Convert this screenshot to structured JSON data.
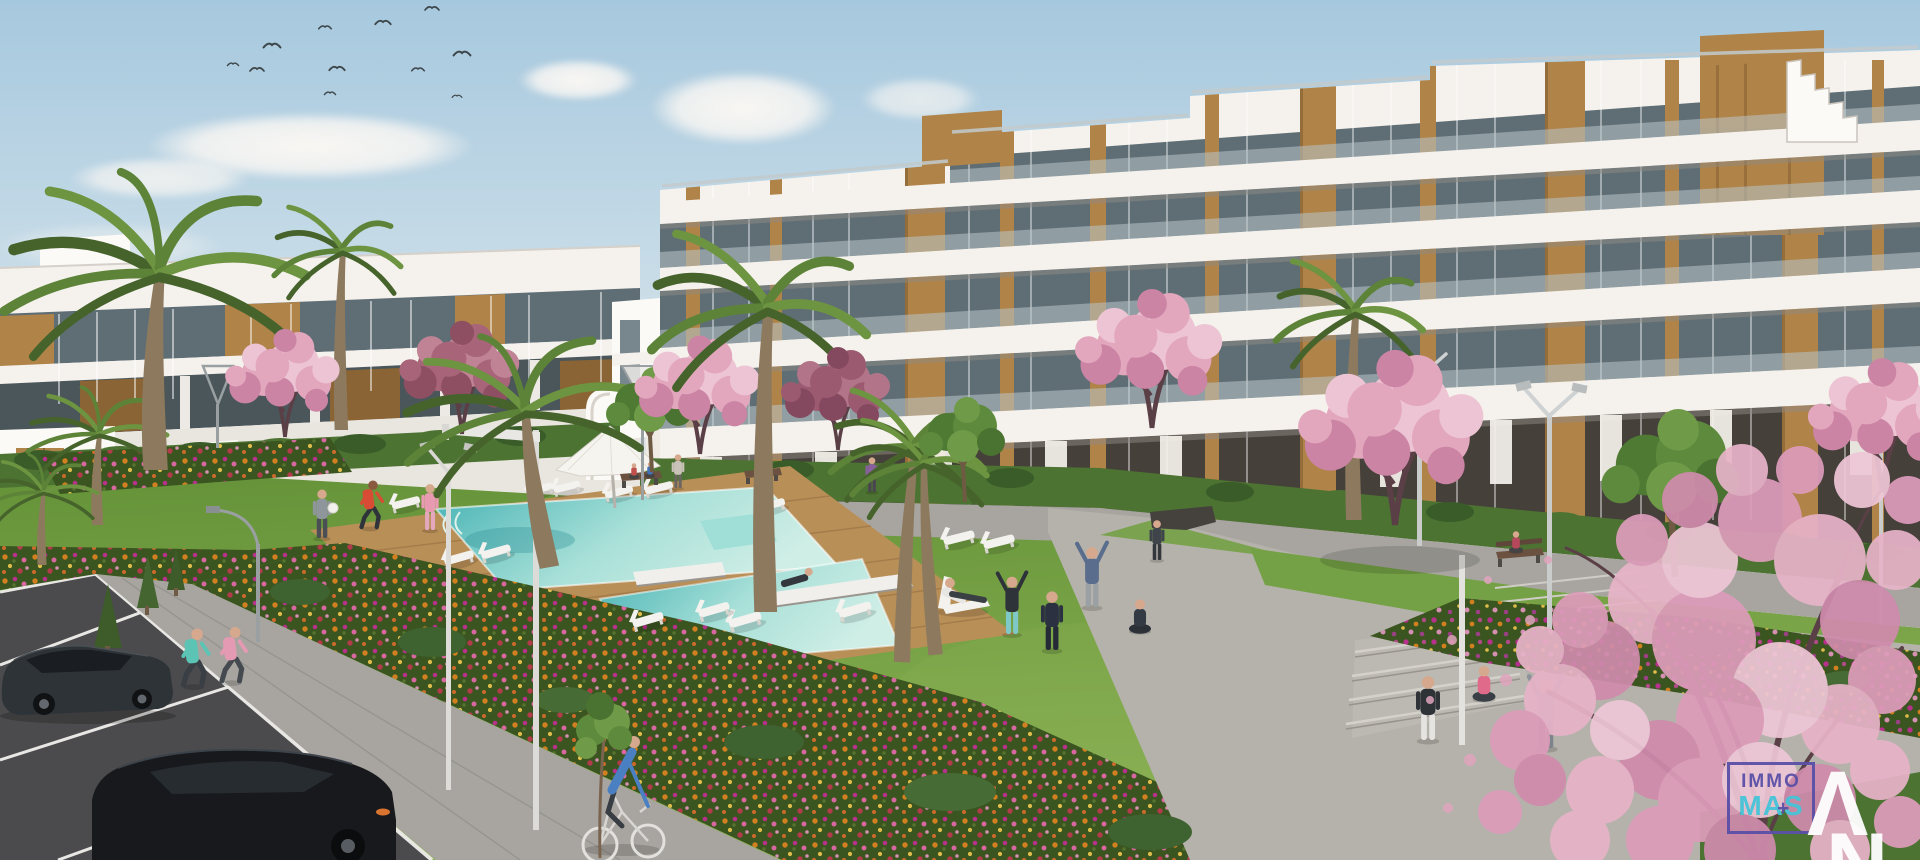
{
  "watermark": {
    "line1": "IMMO",
    "line2": "MAS",
    "plus": "+",
    "letter_top": "Λ",
    "letter_bottom": "N"
  },
  "scene": {
    "description": "3D architectural rendering of a modern white apartment complex with wooden accent panels, a communal swimming pool with timber deck, sun loungers and a parasol, lawns with residents exercising and doing yoga, colourful flower beds, palm and cherry-blossom trees, footpaths, benches, street lamps, a cyclist, two joggers and a parking area with two dark cars under a blue sky with birds",
    "people_count": 22,
    "cars_count": 2,
    "elements": [
      "sky",
      "clouds",
      "birds",
      "left-apartment-building",
      "right-apartment-building",
      "arched-stairwell",
      "swimming-pool",
      "pool-deck",
      "sun-loungers",
      "parasol",
      "lawn",
      "flower-beds",
      "palm-trees",
      "blossom-trees",
      "green-trees",
      "hedges",
      "footpaths",
      "plaza",
      "steps",
      "benches",
      "street-lamps",
      "people-exercising",
      "joggers",
      "cyclist",
      "parking-lot",
      "cars",
      "developer-watermark"
    ]
  },
  "palette": {
    "sky_top": "#a6c8de",
    "sky_mid": "#c6dbe7",
    "sky_horizon": "#ece7e0",
    "cloud": "#f8f5f1",
    "building_white": "#f5f2ed",
    "building_white2": "#fbfaf7",
    "building_shade": "#e9e5df",
    "band_soffit": "#8f8a83",
    "glass_dark": "#5f6e75",
    "glass_mid": "#78878d",
    "glass_light": "#b9c6ca",
    "wood": "#b08348",
    "wood_dark": "#8a6434",
    "hedge": "#4c7332",
    "hedge_dark": "#3a5c29",
    "lawn_dark": "#649238",
    "lawn_light": "#8ab153",
    "lawn_flat": "#74a145",
    "pool_deep": "#45b2b4",
    "pool_mid": "#a8e0d8",
    "pool_pale": "#cfeee6",
    "deck": "#b98f58",
    "deck_dark": "#9c7544",
    "path": "#a8a5a0",
    "path_dark": "#8f8c86",
    "plaza": "#b5b2ab",
    "asphalt": "#4b4b4d",
    "line_white": "#e8e7e4",
    "flower_base": "#3a5520",
    "flower_orange": "#d2801f",
    "flower_magenta": "#b5318a",
    "flower_pink": "#d8679f",
    "flower_yellow": "#e0bd4a",
    "flower_red": "#b33a4a",
    "flower_rose": "#d58fb0",
    "blossom": "#e2a6bd",
    "blossom_light": "#edc4d3",
    "blossom_deep": "#cb84a4",
    "trunk": "#8d7a5e",
    "branch": "#5a3f46",
    "palm": "#5d8338",
    "palm_dark": "#46632c",
    "palm_light": "#6d9440",
    "tree_green": "#5d8a3c",
    "lamp": "#dcdbd7",
    "car_dark": "#17191c",
    "car_body": "#2e3338",
    "skin": "#d6a88d",
    "logo_purple": "#5a50a7",
    "logo_cyan": "#45c4d8"
  }
}
